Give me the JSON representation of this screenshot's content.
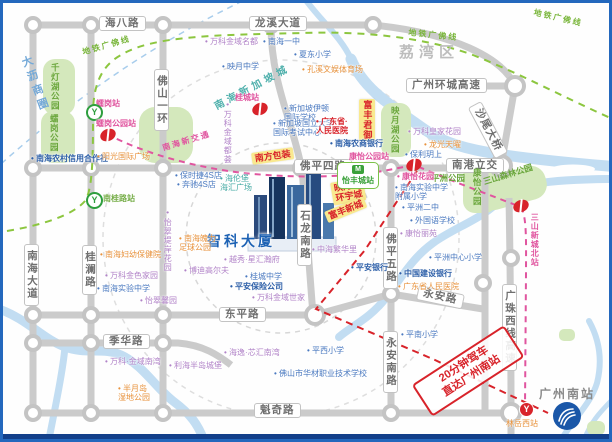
{
  "district": "荔湾区",
  "building": {
    "name": "智科大厦"
  },
  "gz_south": {
    "label": "广州南站"
  },
  "stamp": {
    "line1": "20分钟驾车",
    "line2": "直达广州南站"
  },
  "colors": {
    "frame_blue": "#2468bd",
    "road_gray": "#cbcbcb",
    "river_blue": "#c2ddf2",
    "metro_guangfo_green": "#8cc63f",
    "nanhai_transit_pink": "#e0559f",
    "route_red": "#d8232a",
    "park_green": "#d4e8bc",
    "tag_yellow": "#f9e98f"
  },
  "road_labels": [
    {
      "t": "海八路",
      "x": 96,
      "y": 13
    },
    {
      "t": "龙溪大道",
      "x": 246,
      "y": 13
    },
    {
      "t": "广州环城高速",
      "x": 403,
      "y": 75
    },
    {
      "t": "沙尾大桥",
      "x": 478,
      "y": 98,
      "r": 62
    },
    {
      "t": "佛山一环",
      "x": 151,
      "y": 66,
      "v": 1
    },
    {
      "t": "佛平四路",
      "x": 291,
      "y": 156
    },
    {
      "t": "南港立交",
      "x": 443,
      "y": 155
    },
    {
      "t": "石龙南路",
      "x": 294,
      "y": 201,
      "v": 1
    },
    {
      "t": "南海大道",
      "x": 21,
      "y": 241,
      "v": 1
    },
    {
      "t": "桂澜路",
      "x": 79,
      "y": 242,
      "v": 1
    },
    {
      "t": "佛平五路",
      "x": 380,
      "y": 224,
      "v": 1
    },
    {
      "t": "永安南路",
      "x": 380,
      "y": 328,
      "v": 1
    },
    {
      "t": "永安路",
      "x": 416,
      "y": 282,
      "r": 12
    },
    {
      "t": "东平路",
      "x": 216,
      "y": 304
    },
    {
      "t": "季华路",
      "x": 100,
      "y": 331
    },
    {
      "t": "魁奇路",
      "x": 251,
      "y": 400
    },
    {
      "t": "广珠西线高速",
      "x": 499,
      "y": 281,
      "v": 1
    }
  ],
  "metro_line_labels": [
    {
      "t": "地铁广佛线",
      "x": 78,
      "y": 44,
      "r": -16,
      "c": "ml-green"
    },
    {
      "t": "地铁广佛线",
      "x": 406,
      "y": 24,
      "r": 6,
      "c": "ml-green"
    },
    {
      "t": "地铁广佛线",
      "x": 532,
      "y": 4,
      "r": 13,
      "c": "ml-green"
    },
    {
      "t": "南海新交通",
      "x": 158,
      "y": 140,
      "r": -17,
      "c": "ml-pink"
    }
  ],
  "curved_texts": [
    {
      "t": "南海新加坡城",
      "x": 208,
      "y": 96,
      "r": -28,
      "c": "#4fb0ac",
      "fs": 10
    },
    {
      "t": "大沥商圈",
      "x": 14,
      "y": 56,
      "r": -20,
      "c": "#74a9d8",
      "fs": 11,
      "v": 1
    }
  ],
  "park_labels": [
    {
      "t": "千灯湖公园",
      "x": 47,
      "y": 60,
      "v": 1
    },
    {
      "t": "𧒽岗公园",
      "x": 46,
      "y": 111,
      "v": 1
    },
    {
      "t": "映月湖公园",
      "x": 387,
      "y": 103,
      "v": 1
    },
    {
      "t": "康怡公园",
      "x": 469,
      "y": 165,
      "v": 1
    },
    {
      "t": "平洲公园",
      "x": 428,
      "y": 170
    },
    {
      "t": "三山森林公园",
      "x": 479,
      "y": 174,
      "r": -17
    }
  ],
  "yellow_tags": [
    {
      "t": "南方包装",
      "x": 248,
      "y": 150,
      "r": -8
    },
    {
      "t": "富丰君御",
      "x": 356,
      "y": 96,
      "v": 1
    },
    {
      "t": "映月湖\n环宇城",
      "x": 327,
      "y": 180,
      "r": -10
    },
    {
      "t": "富丰新城",
      "x": 321,
      "y": 209,
      "r": -22
    }
  ],
  "pois": [
    {
      "t": "万科金域名都",
      "x": 202,
      "y": 34,
      "c": "purple"
    },
    {
      "t": "南海一中",
      "x": 260,
      "y": 34,
      "c": "blue"
    },
    {
      "t": "夏东小学",
      "x": 291,
      "y": 47,
      "c": "blue"
    },
    {
      "t": "映月中学",
      "x": 219,
      "y": 59,
      "c": "blue"
    },
    {
      "t": "孔溪文娱体育场",
      "x": 299,
      "y": 62,
      "c": "orange"
    },
    {
      "t": "新加坡伊顿\n国际学校",
      "x": 281,
      "y": 101,
      "c": "blue"
    },
    {
      "t": "新加坡国立大学\n国际考试中心",
      "x": 270,
      "y": 116,
      "c": "blue"
    },
    {
      "t": "广东省·\n人民医院",
      "x": 313,
      "y": 114,
      "c": "red"
    },
    {
      "t": "南海农商银行",
      "x": 327,
      "y": 136,
      "c": "blueb"
    },
    {
      "t": "南海农村信用合作社",
      "x": 28,
      "y": 151,
      "c": "blueb"
    },
    {
      "t": "阳光国际广场",
      "x": 94,
      "y": 149,
      "c": "orange"
    },
    {
      "t": "保时捷4S店",
      "x": 172,
      "y": 168,
      "c": "blue"
    },
    {
      "t": "奔驰4S店",
      "x": 174,
      "y": 177,
      "c": "blue"
    },
    {
      "t": "海伦堡\n海汇广场",
      "x": 217,
      "y": 171,
      "c": "teal"
    },
    {
      "t": "万科皇家花园",
      "x": 405,
      "y": 124,
      "c": "purple"
    },
    {
      "t": "龙光天曜",
      "x": 421,
      "y": 137,
      "c": "orange"
    },
    {
      "t": "保利玥上",
      "x": 402,
      "y": 147,
      "c": "blue"
    },
    {
      "t": "康怡花园",
      "x": 394,
      "y": 169,
      "c": "magenta"
    },
    {
      "t": "南海实验中学\n附属小学",
      "x": 392,
      "y": 180,
      "c": "blue"
    },
    {
      "t": "平洲二中",
      "x": 399,
      "y": 200,
      "c": "blue"
    },
    {
      "t": "外国语学校",
      "x": 407,
      "y": 213,
      "c": "blue"
    },
    {
      "t": "康怡丽苑",
      "x": 397,
      "y": 226,
      "c": "purple"
    },
    {
      "t": "平洲中心小学",
      "x": 426,
      "y": 250,
      "c": "blue"
    },
    {
      "t": "平安银行",
      "x": 348,
      "y": 260,
      "c": "blueb"
    },
    {
      "t": "中国建设银行",
      "x": 396,
      "y": 266,
      "c": "blueb"
    },
    {
      "t": "广东省人民医院",
      "x": 395,
      "y": 279,
      "c": "orange"
    },
    {
      "t": "中海繁华里",
      "x": 309,
      "y": 242,
      "c": "purple"
    },
    {
      "t": "越秀·星汇瀚府",
      "x": 221,
      "y": 252,
      "c": "purple"
    },
    {
      "t": "博迪高尔夫",
      "x": 181,
      "y": 263,
      "c": "purple"
    },
    {
      "t": "南海魄力\n足球公园",
      "x": 176,
      "y": 231,
      "c": "orange"
    },
    {
      "t": "桂城中学",
      "x": 242,
      "y": 269,
      "c": "blue"
    },
    {
      "t": "平安保险公司",
      "x": 227,
      "y": 279,
      "c": "blueb"
    },
    {
      "t": "万科金域世家",
      "x": 249,
      "y": 290,
      "c": "purple"
    },
    {
      "t": "南海妇幼保健院",
      "x": 97,
      "y": 247,
      "c": "orange"
    },
    {
      "t": "万科金色家园",
      "x": 102,
      "y": 268,
      "c": "purple"
    },
    {
      "t": "南海实验中学",
      "x": 94,
      "y": 281,
      "c": "blue"
    },
    {
      "t": "怡翠馨园",
      "x": 137,
      "y": 293,
      "c": "purple"
    },
    {
      "t": "怡翠堤岸花园",
      "x": 160,
      "y": 208,
      "c": "purple",
      "v": 1
    },
    {
      "t": "万科·金域南湾",
      "x": 102,
      "y": 354,
      "c": "purple"
    },
    {
      "t": "利海半岛城堡",
      "x": 166,
      "y": 358,
      "c": "purple"
    },
    {
      "t": "海逸·芯汇南湾",
      "x": 221,
      "y": 345,
      "c": "purple"
    },
    {
      "t": "半月岛\n湿地公园",
      "x": 115,
      "y": 381,
      "c": "orange"
    },
    {
      "t": "平西小学",
      "x": 304,
      "y": 343,
      "c": "blue"
    },
    {
      "t": "佛山市华材职业技术学校",
      "x": 271,
      "y": 366,
      "c": "blue"
    },
    {
      "t": "平南小学",
      "x": 398,
      "y": 327,
      "c": "blue"
    },
    {
      "t": "万科金域都荟",
      "x": 220,
      "y": 100,
      "c": "purple",
      "v": 1
    }
  ],
  "stations": [
    {
      "t": "𧒽岗站",
      "x": 93,
      "y": 96,
      "c": "magenta",
      "mk": "yg",
      "mx": 83,
      "my": 101
    },
    {
      "t": "𧒽岗公园站",
      "x": 93,
      "y": 116,
      "c": "magenta",
      "mk": "dot",
      "mx": 97,
      "my": 126
    },
    {
      "t": "桂城站",
      "x": 232,
      "y": 90,
      "c": "magenta",
      "mk": "dot",
      "mx": 249,
      "my": 100
    },
    {
      "t": "南桂路站",
      "x": 100,
      "y": 191,
      "c": "green",
      "mk": "yg",
      "mx": 83,
      "my": 189
    },
    {
      "t": "康怡公园站",
      "x": 346,
      "y": 149,
      "c": "magenta",
      "mk": "dot",
      "mx": 403,
      "my": 156
    },
    {
      "t": "三山新城北站",
      "x": 527,
      "y": 210,
      "c": "magenta",
      "v": 1,
      "mk": "dot",
      "mx": 510,
      "my": 197
    },
    {
      "t": "林岳西站",
      "x": 503,
      "y": 416,
      "c": "orange",
      "mk": "yr",
      "mx": 516,
      "my": 399
    }
  ],
  "station_badge": {
    "label": "怡丰城站",
    "x": 334,
    "y": 159,
    "icon": "metro-train-icon"
  }
}
